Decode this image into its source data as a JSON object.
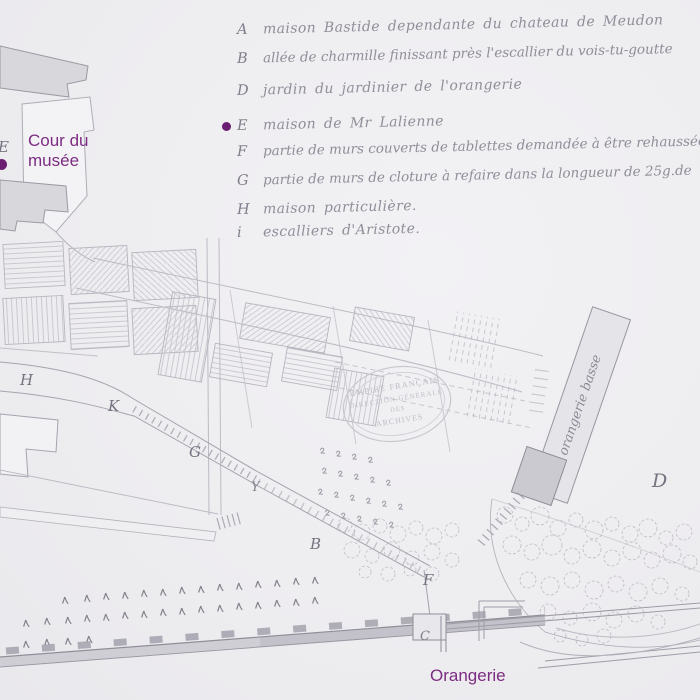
{
  "colors": {
    "paper": "#eeedf0",
    "pencil": "#a8a7b1",
    "accent_purple": "#7c2c82",
    "dot_purple": "#6b1d72"
  },
  "labels": {
    "cour_line1": "Cour du",
    "cour_line2": "musée",
    "orangerie": "Orangerie"
  },
  "legend": {
    "items": [
      {
        "letter": "A",
        "text": "maison Bastide dependante du chateau de Meudon"
      },
      {
        "letter": "B",
        "text": "allée de charmille finissant près l'escallier du vois-tu-goutte"
      },
      {
        "letter": "D",
        "text": "jardin du jardinier de l'orangerie"
      },
      {
        "letter": "E",
        "text": "maison de Mr Lalienne",
        "marked": "purple-dot"
      },
      {
        "letter": "F",
        "text": "partie de murs couverts de tablettes demandée à être rehaussée"
      },
      {
        "letter": "G",
        "text": "partie de murs de cloture à refaire dans la longueur de 25g.de"
      },
      {
        "letter": "H",
        "text": "maison particulière."
      },
      {
        "letter": "i",
        "text": "escalliers d'Aristote."
      }
    ]
  },
  "stamp": {
    "line1": "EMPIRE FRANÇAIS",
    "line2": "DIRECTION GÉNÉRALE",
    "line3": "DES",
    "line4": "ARCHIVES"
  },
  "strip_label": "orangerie basse",
  "map_letters": [
    {
      "char": "E"
    },
    {
      "char": "H"
    },
    {
      "char": "K"
    },
    {
      "char": "G"
    },
    {
      "char": "Y"
    },
    {
      "char": "B"
    },
    {
      "char": "F"
    },
    {
      "char": "C"
    },
    {
      "char": "D"
    }
  ]
}
